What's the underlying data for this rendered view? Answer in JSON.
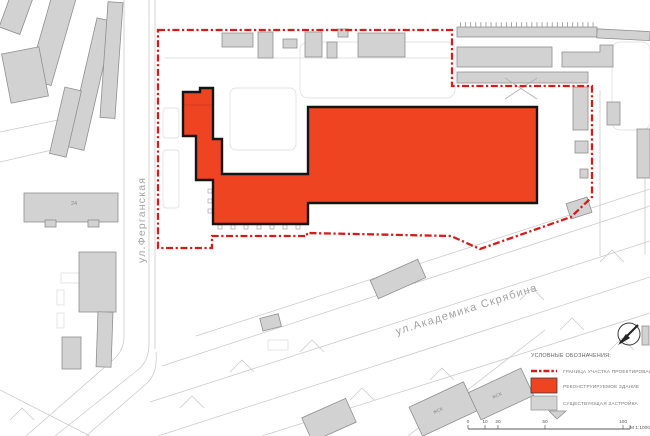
{
  "map": {
    "streets": {
      "vertical": "ул.Ферганская",
      "diagonal": "ул.Академика  Скрябина"
    },
    "building_labels": {
      "b24": "24",
      "zhsk_a": "ЖСК",
      "zhsk_b": "ЖСК"
    }
  },
  "legend": {
    "title": "УСЛОВНЫЕ ОБОЗНАЧЕНИЯ:",
    "items": [
      {
        "swatch": "boundary-dash-line",
        "label": "ГРАНИЦА УЧАСТКА ПРОЕКТИРОВАНИЯ"
      },
      {
        "swatch": "red-fill",
        "label": "РЕКОНСТРУИРУЕМОЕ ЗДАНИЕ"
      },
      {
        "swatch": "gray-fill",
        "label": "СУЩЕСТВУЮЩАЯ ЗАСТРОЙКА"
      }
    ]
  },
  "scale_bar": {
    "ticks": [
      "0",
      "10",
      "20",
      "50",
      "100"
    ],
    "scale_label": "М 1:1000"
  },
  "colors": {
    "boundary": "#d61b1b",
    "reconstructed_fill": "#ee4422",
    "existing_fill": "#d2d2d2",
    "road_line": "#c9c9c9"
  }
}
